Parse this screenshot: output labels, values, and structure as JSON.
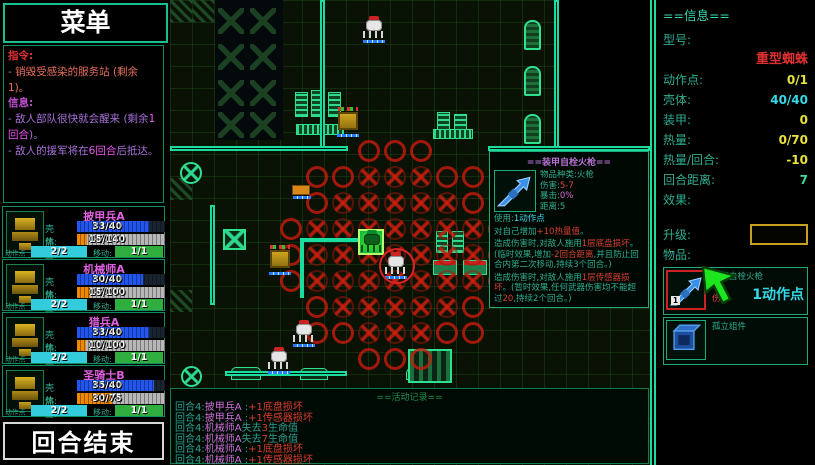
{
  "sidebar": {
    "menu_title": "菜单",
    "orders_label": "指令:",
    "orders": [
      "- 销毁受感染的服务站 (剩余1)。"
    ],
    "info_label": "信息:",
    "info_lines": [
      {
        "pre": "- 敌人部队很快就会醒来 (剩余",
        "hl": "1回合",
        "post": ")。"
      },
      {
        "pre": "- 敌人的援军将在",
        "hl": "6回合",
        "post": "后抵达。"
      }
    ],
    "end_turn_label": "回合结束"
  },
  "unit_labels": {
    "hull": "壳体:",
    "heat": "热量:",
    "ap": "动作点",
    "move": "移动:"
  },
  "units": [
    {
      "name": "披甲兵A",
      "hull": "33/40",
      "hull_pct": 82,
      "heat": "15/140",
      "heat_pct": 11,
      "ap": "2/2",
      "move": "1/1"
    },
    {
      "name": "机械师A",
      "hull": "30/40",
      "hull_pct": 75,
      "heat": "15/100",
      "heat_pct": 15,
      "ap": "2/2",
      "move": "1/1"
    },
    {
      "name": "猎兵A",
      "hull": "33/40",
      "hull_pct": 82,
      "heat": "10/100",
      "heat_pct": 10,
      "ap": "2/2",
      "move": "1/1"
    },
    {
      "name": "圣骑士B",
      "hull": "35/40",
      "hull_pct": 87,
      "heat": "30/75",
      "heat_pct": 40,
      "ap": "2/2",
      "move": "1/1"
    }
  ],
  "info_panel": {
    "title": "==信息==",
    "model_label": "型号:",
    "model_value": "重型蜘蛛",
    "stats": [
      {
        "label": "动作点:",
        "value": "0/1",
        "color": "#e8e23a"
      },
      {
        "label": "壳体:",
        "value": "40/40",
        "color": "#35d8e8"
      },
      {
        "label": "装甲:",
        "value": "0",
        "color": "#e8e23a"
      },
      {
        "label": "热量:",
        "value": "0/70",
        "color": "#e8e23a"
      },
      {
        "label": "热量/回合:",
        "value": "-10",
        "color": "#e8e23a"
      },
      {
        "label": "回合距离:",
        "value": "7",
        "color": "#3fd89a"
      }
    ],
    "effects_label": "效果:",
    "upgrade_label": "升级:",
    "items_label": "物品:",
    "items": [
      {
        "name": "装甲自栓火枪",
        "sub": "伤害",
        "sub_color": "#e04444",
        "cost": "1动作点",
        "badge": "1",
        "selected": true,
        "icon": "rifle-icon"
      },
      {
        "name": "孤立组件",
        "sub": "",
        "sub_color": "",
        "cost": "",
        "badge": "",
        "selected": false,
        "icon": "component-icon"
      }
    ]
  },
  "tooltip": {
    "title": "==装甲自栓火枪==",
    "stats": [
      {
        "label": "物品种类:",
        "value": "火枪",
        "color": "#2fae8f"
      },
      {
        "label": "伤害:",
        "value": "5-7",
        "color": "#e04444"
      },
      {
        "label": "暴击:",
        "value": "0%",
        "color": "#d86fd8"
      },
      {
        "label": "距离:",
        "value": "5",
        "color": "#2fae8f"
      }
    ],
    "lines": [
      [
        {
          "t": "使用:",
          "c": "lbl"
        },
        {
          "t": "1动作点",
          "c": "cyan"
        }
      ],
      [
        {
          "t": "对自己增加",
          "c": "body"
        },
        {
          "t": "+10热量值",
          "c": "hl"
        },
        {
          "t": "。",
          "c": "body"
        }
      ],
      [
        {
          "t": "造成伤害时,对敌人施用",
          "c": "body"
        },
        {
          "t": "1层底盘损坏",
          "c": "hl"
        },
        {
          "t": "。(临时效果,增加",
          "c": "body"
        },
        {
          "t": "-2回合距离",
          "c": "hl"
        },
        {
          "t": ",并且防止回合内第二次移动,持续3个回合。)",
          "c": "body"
        }
      ],
      [
        {
          "t": "造成伤害时,对敌人施用",
          "c": "body"
        },
        {
          "t": "1层传感器损坏",
          "c": "hl"
        },
        {
          "t": "。(暂时效果,任何武器伤害均不能超过",
          "c": "body"
        },
        {
          "t": "20",
          "c": "hl"
        },
        {
          "t": ",持续2个回合。)",
          "c": "body"
        }
      ]
    ]
  },
  "log": {
    "title": "==活动记录==",
    "entries": [
      {
        "turn": "回合4:",
        "unit": "披甲兵A",
        "mid": " :",
        "hl": "+1底盘损坏",
        "post": ""
      },
      {
        "turn": "回合4:",
        "unit": "披甲兵A",
        "mid": " :",
        "hl": "+1传感器损坏",
        "post": ""
      },
      {
        "turn": "回合4:",
        "unit": "机械师A",
        "mid": "失去",
        "hl": "3",
        "post": "生命值"
      },
      {
        "turn": "回合4:",
        "unit": "机械师A",
        "mid": "失去",
        "hl": "7",
        "post": "生命值"
      },
      {
        "turn": "回合4:",
        "unit": "机械师A",
        "mid": " :",
        "hl": "+1底盘损坏",
        "post": ""
      },
      {
        "turn": "回合4:",
        "unit": "机械师A",
        "mid": " :",
        "hl": "+1传感器损坏",
        "post": ""
      }
    ]
  },
  "map": {
    "fog": [
      {
        "x": 388,
        "y": 0,
        "w": 92,
        "h": 148
      }
    ],
    "walls": [
      {
        "x": 150,
        "y": 0,
        "w": 5,
        "h": 150
      },
      {
        "x": 0,
        "y": 146,
        "w": 178,
        "h": 5
      },
      {
        "x": 318,
        "y": 146,
        "w": 162,
        "h": 5
      },
      {
        "x": 384,
        "y": 0,
        "w": 5,
        "h": 148
      },
      {
        "x": 40,
        "y": 205,
        "w": 5,
        "h": 100
      },
      {
        "x": 55,
        "y": 371,
        "w": 122,
        "h": 5
      }
    ],
    "objects": [
      {
        "x": 45,
        "y": 0,
        "w": 68,
        "h": 140,
        "k": "darkcol"
      },
      {
        "x": 48,
        "y": 8,
        "w": 26,
        "h": 26,
        "k": "bigx"
      },
      {
        "x": 80,
        "y": 8,
        "w": 26,
        "h": 26,
        "k": "bigx"
      },
      {
        "x": 48,
        "y": 44,
        "w": 26,
        "h": 26,
        "k": "bigx"
      },
      {
        "x": 80,
        "y": 44,
        "w": 26,
        "h": 26,
        "k": "bigx"
      },
      {
        "x": 48,
        "y": 80,
        "w": 26,
        "h": 26,
        "k": "bigx"
      },
      {
        "x": 80,
        "y": 80,
        "w": 26,
        "h": 26,
        "k": "bigx"
      },
      {
        "x": 48,
        "y": 112,
        "w": 26,
        "h": 26,
        "k": "bigx"
      },
      {
        "x": 80,
        "y": 112,
        "w": 26,
        "h": 26,
        "k": "bigx"
      },
      {
        "x": 0,
        "y": 0,
        "w": 22,
        "h": 22,
        "k": "hatch"
      },
      {
        "x": 22,
        "y": 0,
        "w": 22,
        "h": 22,
        "k": "hatch"
      },
      {
        "x": 0,
        "y": 178,
        "w": 22,
        "h": 22,
        "k": "hatch"
      },
      {
        "x": 0,
        "y": 290,
        "w": 22,
        "h": 22,
        "k": "hatch"
      },
      {
        "x": 354,
        "y": 20,
        "w": 17,
        "h": 30,
        "k": "tank"
      },
      {
        "x": 354,
        "y": 66,
        "w": 17,
        "h": 30,
        "k": "tank"
      },
      {
        "x": 354,
        "y": 114,
        "w": 17,
        "h": 30,
        "k": "tank"
      },
      {
        "x": 125,
        "y": 92,
        "w": 13,
        "h": 25,
        "k": "rack-v"
      },
      {
        "x": 141,
        "y": 90,
        "w": 13,
        "h": 27,
        "k": "rack-v"
      },
      {
        "x": 158,
        "y": 92,
        "w": 13,
        "h": 25,
        "k": "rack-v"
      },
      {
        "x": 126,
        "y": 124,
        "w": 48,
        "h": 11,
        "k": "rack-h"
      },
      {
        "x": 267,
        "y": 112,
        "w": 13,
        "h": 25,
        "k": "rack-v"
      },
      {
        "x": 284,
        "y": 114,
        "w": 13,
        "h": 23,
        "k": "rack-v"
      },
      {
        "x": 263,
        "y": 129,
        "w": 40,
        "h": 10,
        "k": "rack-h"
      },
      {
        "x": 53,
        "y": 229,
        "w": 23,
        "h": 21,
        "k": "crate"
      },
      {
        "x": 10,
        "y": 162,
        "w": 22,
        "h": 22,
        "k": "fan"
      },
      {
        "x": 11,
        "y": 366,
        "w": 21,
        "h": 21,
        "k": "fan"
      },
      {
        "x": 61,
        "y": 367,
        "w": 30,
        "h": 13,
        "k": "bench"
      },
      {
        "x": 130,
        "y": 368,
        "w": 28,
        "h": 12,
        "k": "bench"
      },
      {
        "x": 236,
        "y": 368,
        "w": 28,
        "h": 12,
        "k": "bench"
      },
      {
        "x": 238,
        "y": 349,
        "w": 44,
        "h": 34,
        "k": "machine"
      },
      {
        "x": 266,
        "y": 231,
        "w": 12,
        "h": 22,
        "k": "rack-v"
      },
      {
        "x": 282,
        "y": 231,
        "w": 12,
        "h": 22,
        "k": "rack-v"
      },
      {
        "x": 263,
        "y": 260,
        "w": 24,
        "h": 15,
        "k": "rack-red"
      },
      {
        "x": 293,
        "y": 260,
        "w": 24,
        "h": 15,
        "k": "rack-red"
      }
    ],
    "range": {
      "cx": 225,
      "cy": 255,
      "tile": 26,
      "radius": 4.45,
      "ring_from": 3.5
    },
    "path": [
      {
        "x": 130,
        "y": 238,
        "w": 64,
        "h": 4
      },
      {
        "x": 130,
        "y": 238,
        "w": 4,
        "h": 60
      }
    ],
    "selected_tile": {
      "x": 188,
      "y": 229,
      "w": 26,
      "h": 26
    },
    "sprites": [
      {
        "x": 192,
        "y": 16,
        "k": "spider-white",
        "name": "enemy-spider"
      },
      {
        "x": 166,
        "y": 110,
        "k": "mech-yellow",
        "name": "ally-mech"
      },
      {
        "x": 122,
        "y": 185,
        "k": "mini-yellow",
        "name": "ally-mini"
      },
      {
        "x": 98,
        "y": 248,
        "k": "mech-yellow",
        "name": "ally-mech"
      },
      {
        "x": 190,
        "y": 230,
        "k": "spider-green",
        "name": "selected-unit-spider"
      },
      {
        "x": 214,
        "y": 252,
        "k": "spider-ringed",
        "name": "enemy-spider-targeted"
      },
      {
        "x": 122,
        "y": 320,
        "k": "spider-white",
        "name": "enemy-spider"
      },
      {
        "x": 97,
        "y": 347,
        "k": "spider-white",
        "name": "enemy-spider"
      }
    ]
  }
}
